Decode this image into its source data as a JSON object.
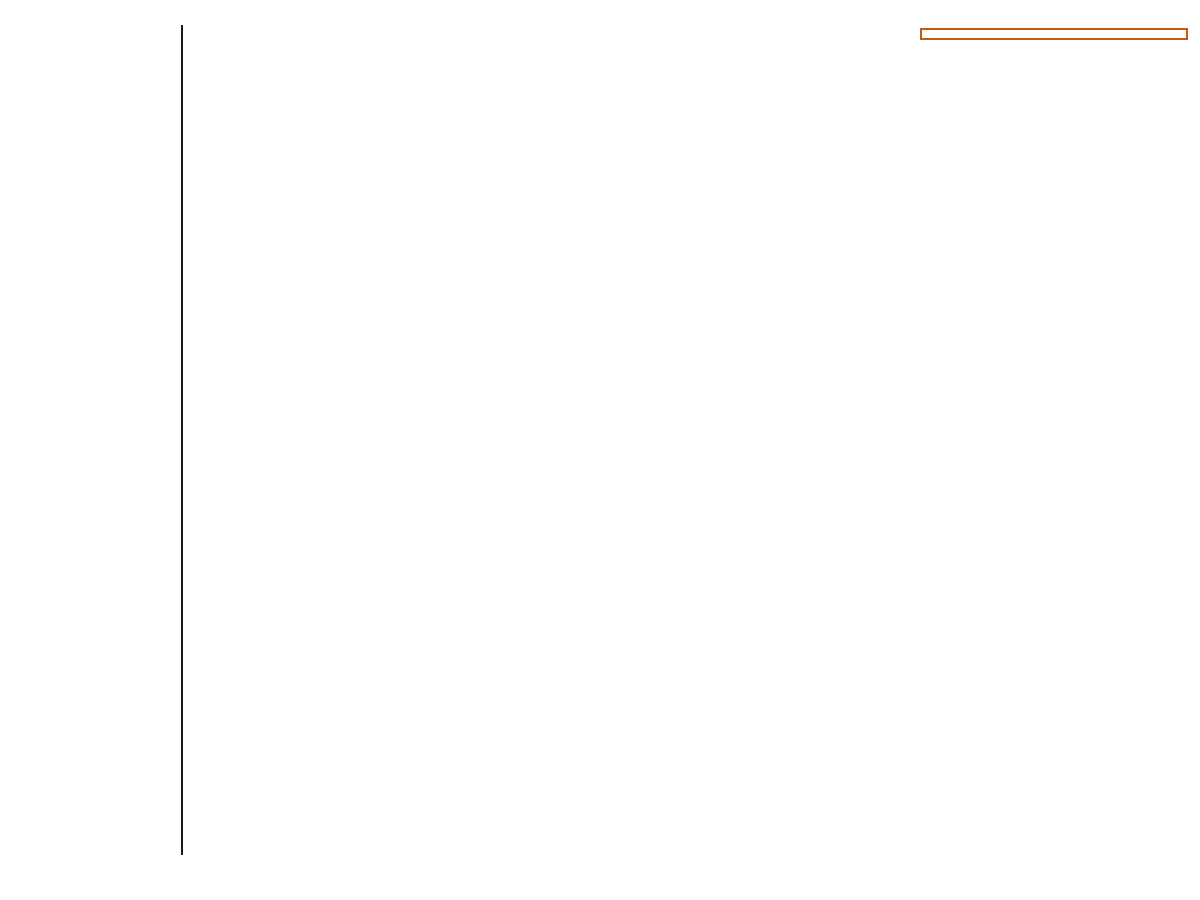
{
  "title": {
    "line1": "Construction Heuristic:",
    "line2": "Cheapest Insertion",
    "subtitle": "N queens (n = 4)"
  },
  "sidebar": {
    "heading_lines": [
      "all",
      "uninitialized",
      "entities",
      "per step"
    ],
    "end_label": "The end",
    "steps": [
      {
        "label": "Step 0",
        "y": 208,
        "fixed": [],
        "arrow_cols": [
          "A",
          "B",
          "C",
          "D"
        ],
        "green_target": "A0"
      },
      {
        "label": "Step 1",
        "y": 378,
        "fixed": [
          "A0"
        ],
        "arrow_cols": [
          "B",
          "C",
          "D"
        ],
        "green_target": "B2"
      },
      {
        "label": "Step 2",
        "y": 548,
        "fixed": [
          "A0",
          "B2"
        ],
        "arrow_cols": [
          "C",
          "D"
        ],
        "green_target": "D1"
      },
      {
        "label": "Step 3",
        "y": 720,
        "fixed": [
          "A0",
          "B2",
          "D1"
        ],
        "arrow_cols": [
          "C"
        ],
        "green_target": "C3"
      }
    ]
  },
  "info_box": {
    "lines": [
      "n: <= n*n*(n+1)/2",
      "        iterations",
      "4: 4*4 = 40",
      "8: 8*8 = 288",
      "64: 64*64 = 133120"
    ]
  },
  "board_labels": {
    "cols": [
      "A",
      "B",
      "C",
      "D"
    ],
    "rows": [
      "0",
      "1",
      "2",
      "3"
    ]
  },
  "ellipsis_label": "...",
  "unknown_score_label": "?",
  "infeasible_label": "infeasible",
  "root_board": {
    "x": 210,
    "y": 40,
    "score": "0",
    "score_color": "green",
    "index": "0",
    "queens": []
  },
  "tree_rows": [
    {
      "y": 208,
      "ellipsis_x": 972,
      "boards": [
        {
          "x": 210,
          "queens": [
            "A0"
          ],
          "score": "0",
          "score_color": "green",
          "index": "1",
          "state": "active"
        },
        {
          "x": 340,
          "queens": [
            "A1"
          ],
          "score": "?",
          "state": "faded"
        },
        {
          "x": 470,
          "queens": [
            "A2"
          ],
          "score": "?",
          "state": "faded"
        },
        {
          "x": 600,
          "queens": [
            "A3"
          ],
          "score": "?",
          "state": "faded"
        },
        {
          "x": 730,
          "queens": [
            "B0"
          ],
          "score": "?",
          "state": "faded"
        },
        {
          "x": 860,
          "queens": [
            "B1"
          ],
          "score": "?",
          "state": "faded"
        },
        {
          "x": 1030,
          "queens": [
            "D3"
          ],
          "score": "?",
          "state": "faded"
        }
      ]
    },
    {
      "y": 378,
      "ellipsis_x": 972,
      "boards": [
        {
          "x": 210,
          "queens": [
            "A0",
            "B0"
          ],
          "score": "-1",
          "score_color": "red",
          "index": "2",
          "state": "active"
        },
        {
          "x": 340,
          "queens": [
            "A0",
            "B1"
          ],
          "score": "-1",
          "score_color": "red",
          "index": "3",
          "state": "active"
        },
        {
          "x": 470,
          "queens": [
            "A0",
            "B2"
          ],
          "score": "0",
          "score_color": "green",
          "index": "4",
          "state": "active"
        },
        {
          "x": 600,
          "queens": [
            "A0",
            "B3"
          ],
          "score": "?",
          "state": "faded"
        },
        {
          "x": 730,
          "queens": [
            "A0",
            "C0"
          ],
          "score": "?",
          "state": "faded"
        },
        {
          "x": 860,
          "queens": [
            "A0",
            "C1"
          ],
          "score": "?",
          "state": "faded"
        },
        {
          "x": 1030,
          "queens": [
            "A0",
            "D3"
          ],
          "score": "?",
          "state": "faded"
        }
      ]
    },
    {
      "y": 548,
      "ellipsis_x": 972,
      "boards": [
        {
          "x": 210,
          "queens": [
            "A0",
            "B2",
            "C0"
          ],
          "score": "-1",
          "score_color": "red",
          "index": "5",
          "state": "active"
        },
        {
          "x": 340,
          "queens": [
            "A0",
            "B2",
            "C1"
          ],
          "score": "-1",
          "score_color": "red",
          "index": "6",
          "state": "active"
        },
        {
          "x": 470,
          "queens": [
            "A0",
            "B2",
            "C2"
          ],
          "score": "-2",
          "score_color": "red",
          "index": "7",
          "state": "active"
        },
        {
          "x": 600,
          "queens": [
            "A0",
            "B2",
            "C3"
          ],
          "score": "-1",
          "score_color": "red",
          "index": "8",
          "state": "active"
        },
        {
          "x": 730,
          "queens": [
            "A0",
            "B2",
            "D0"
          ],
          "score": "-2",
          "score_color": "red",
          "index": "9",
          "state": "active"
        },
        {
          "x": 860,
          "queens": [
            "A0",
            "B2",
            "D1"
          ],
          "score": "0",
          "score_color": "green",
          "index": "10",
          "state": "active"
        },
        {
          "x": 1030,
          "queens": [
            "A0",
            "B2",
            "D3"
          ],
          "score": "-1",
          "score_color": "red",
          "index": "12",
          "state": "active"
        }
      ]
    },
    {
      "y": 720,
      "ellipsis_x": null,
      "boards": [
        {
          "x": 470,
          "queens": [
            "A0",
            "C0",
            "B2",
            "D1"
          ],
          "score": "-2",
          "score_color": "red",
          "index": "13",
          "state": "active"
        },
        {
          "x": 600,
          "queens": [
            "A0",
            "C1",
            "D1",
            "B2"
          ],
          "score": "-2",
          "score_color": "red",
          "index": "14",
          "state": "active"
        },
        {
          "x": 730,
          "queens": [
            "A0",
            "D1",
            "B2",
            "C2"
          ],
          "score": "-3",
          "score_color": "red",
          "index": "15",
          "state": "active"
        },
        {
          "x": 860,
          "queens": [
            "A0",
            "D1",
            "B2",
            "C3"
          ],
          "score": "-1",
          "score_color": "red",
          "index": "16",
          "state": "active",
          "note": "infeasible"
        }
      ]
    }
  ],
  "fans": [
    {
      "origin": [
        270,
        166
      ],
      "stub_from": [
        270,
        161
      ],
      "target_y": 208,
      "children": [
        {
          "x": 270,
          "type": "selected"
        },
        {
          "x": 401,
          "type": "skipped"
        },
        {
          "x": 531,
          "type": "skipped"
        },
        {
          "x": 661,
          "type": "skipped"
        },
        {
          "x": 791,
          "type": "skipped"
        },
        {
          "x": 921,
          "type": "skipped"
        },
        {
          "x": 1091,
          "type": "skipped"
        }
      ]
    },
    {
      "origin": [
        270,
        338
      ],
      "stub_from": [
        270,
        330
      ],
      "target_y": 378,
      "children": [
        {
          "x": 270,
          "type": "evaluated"
        },
        {
          "x": 401,
          "type": "evaluated"
        },
        {
          "x": 531,
          "type": "selected"
        },
        {
          "x": 661,
          "type": "skipped"
        },
        {
          "x": 791,
          "type": "skipped"
        },
        {
          "x": 921,
          "type": "skipped"
        },
        {
          "x": 1091,
          "type": "skipped"
        }
      ]
    },
    {
      "origin": [
        530,
        508
      ],
      "stub_from": [
        530,
        500
      ],
      "target_y": 548,
      "children": [
        {
          "x": 271,
          "type": "evaluated"
        },
        {
          "x": 401,
          "type": "evaluated"
        },
        {
          "x": 530,
          "type": "evaluated"
        },
        {
          "x": 661,
          "type": "evaluated"
        },
        {
          "x": 791,
          "type": "evaluated"
        },
        {
          "x": 921,
          "type": "selected"
        },
        {
          "x": 1091,
          "type": "evaluated"
        }
      ]
    },
    {
      "origin": [
        890,
        678
      ],
      "stub_from": [
        890,
        670
      ],
      "target_y": 720,
      "children": [
        {
          "x": 531,
          "type": "evaluated"
        },
        {
          "x": 661,
          "type": "evaluated"
        },
        {
          "x": 791,
          "type": "evaluated"
        },
        {
          "x": 890,
          "type": "selected"
        }
      ]
    }
  ],
  "colors": {
    "purple": "#75507b",
    "orange": "#c35a11",
    "blue_index": "#3465a4",
    "score_green": "#61a318",
    "score_red": "#b01e1e",
    "score_unknown": "#aaaaaa",
    "line_green": "#56a019",
    "line_red": "#bb2121",
    "line_pink": "#eec9c9",
    "cell_gray": "#b6bab0",
    "cell_white": "#ffffff",
    "faded_cell_gray": "#ebebe7",
    "queen_gold": "#fcd116",
    "queen_outline": "#4a3b00",
    "queen_faded": "#f0e9c7",
    "queen_faded_outline": "#cfc6a0",
    "board_border": "#333333",
    "faded_board_border": "#b5b5b5",
    "arrow_orange": "#c8852e",
    "arrow_orange_outline": "#7a5410",
    "arrow_green": "#71c837",
    "arrow_green_outline": "#3b7a0a"
  }
}
